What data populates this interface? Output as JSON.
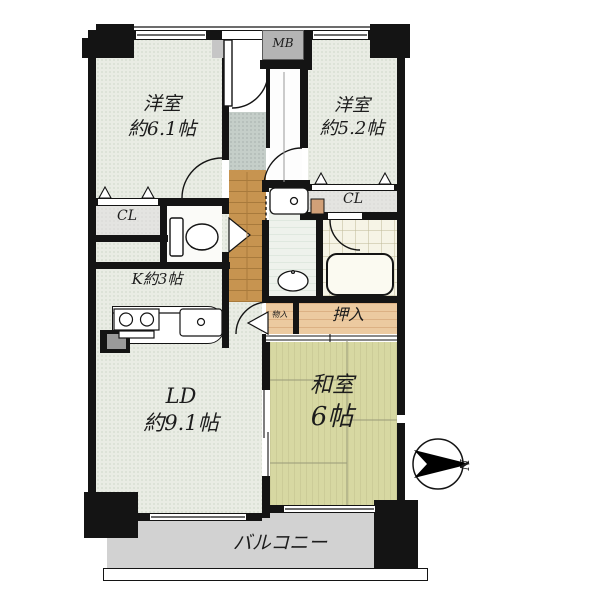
{
  "labels": {
    "western1_name": "洋室",
    "western1_size": "約6.1帖",
    "western2_name": "洋室",
    "western2_size": "約5.2帖",
    "kitchen": "K約3帖",
    "ld_name": "LD",
    "ld_size": "約9.1帖",
    "washitsu_name": "和室",
    "washitsu_size": "6帖",
    "oshiire": "押入",
    "monoire": "物入",
    "closet_left": "CL",
    "closet_right": "CL",
    "meter_box": "MB",
    "balcony": "バルコニー",
    "north": "N"
  },
  "colors": {
    "wall": "#141414",
    "room_floor": "#e9ece4",
    "wood_floor": "#c79450",
    "genkan_tile": "#c5cec9",
    "tatami": "#d7d8a2",
    "oshiire_wood": "#eccaa0",
    "balcony": "#d2d2d2",
    "bath_tile": "#f6f4e6",
    "meter_box": "#b4b4b4"
  }
}
